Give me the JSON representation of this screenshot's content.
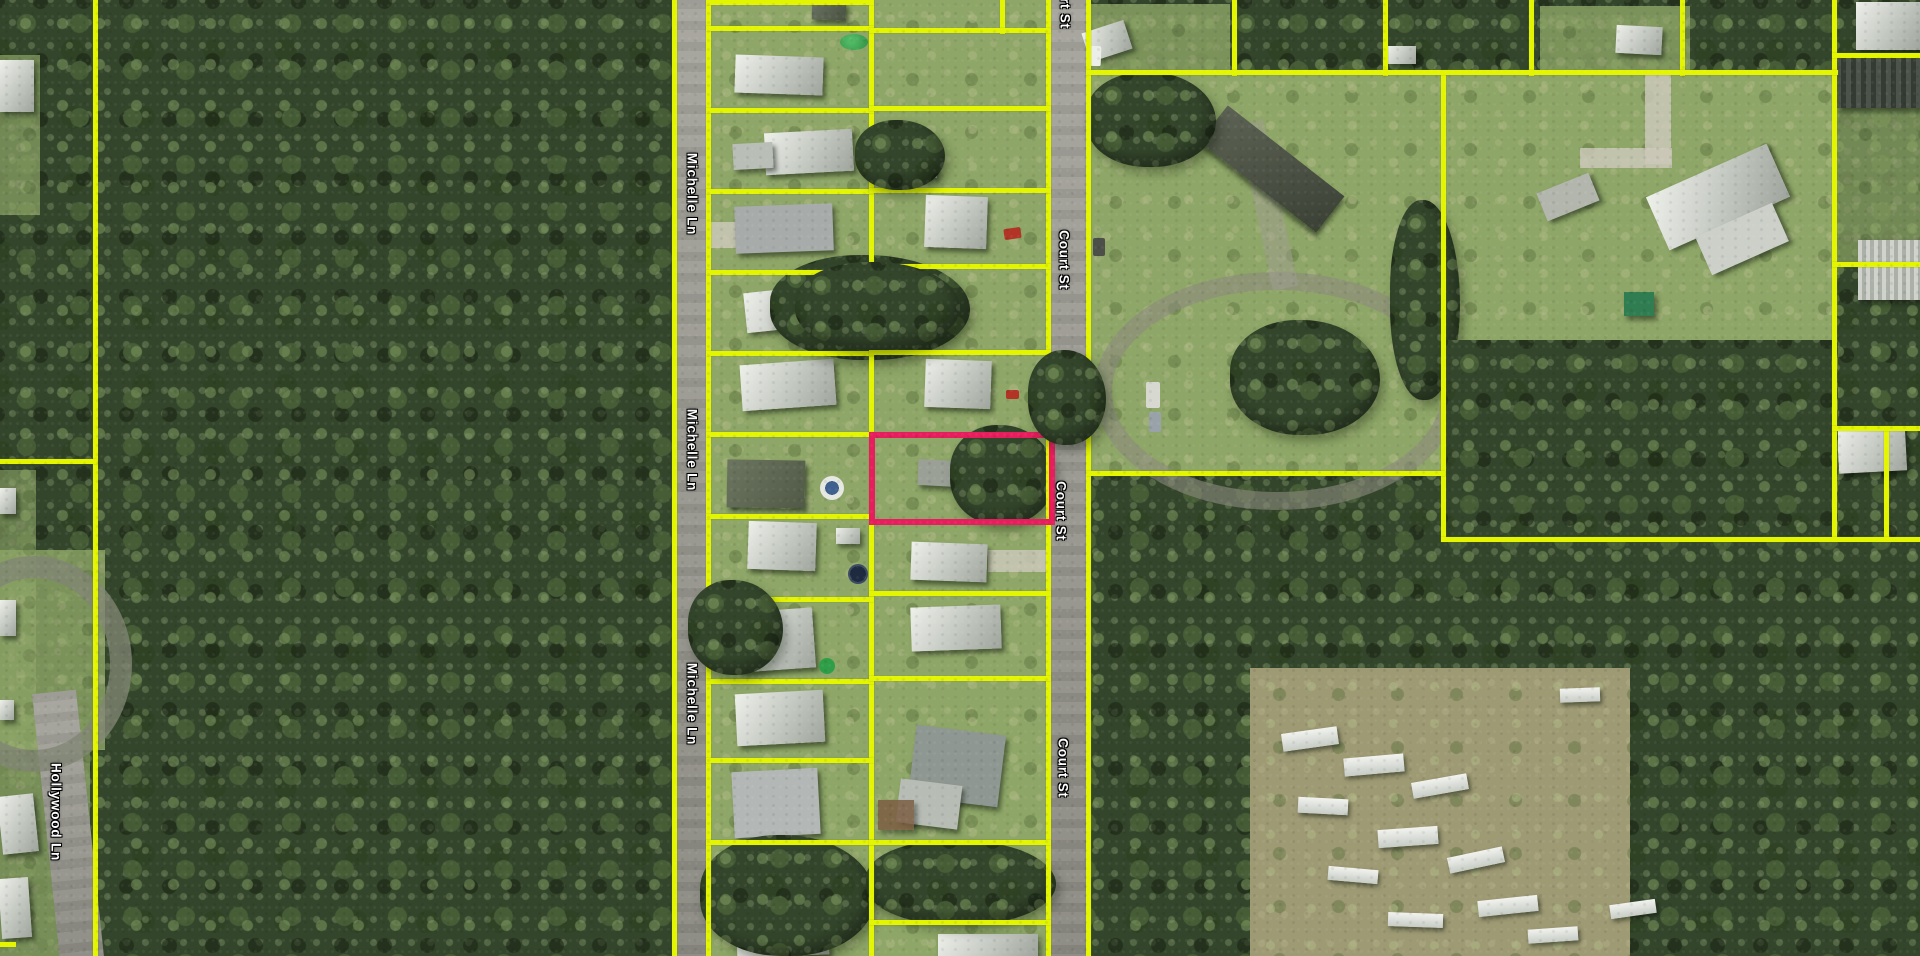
{
  "map": {
    "kind": "aerial-parcel-map",
    "colors": {
      "parcel_line": "#e4f501",
      "highlight_outline": "#e61e5e",
      "road": "#9d9c94"
    },
    "streets": [
      "Michelle Ln",
      "Court St",
      "Hollywood Ln"
    ],
    "labels": [
      {
        "id": "michelle-1",
        "text": "Michelle Ln"
      },
      {
        "id": "michelle-2",
        "text": "Michelle Ln"
      },
      {
        "id": "michelle-3",
        "text": "Michelle Ln"
      },
      {
        "id": "court-top-partial",
        "text": "Court St"
      },
      {
        "id": "court-1",
        "text": "Court St"
      },
      {
        "id": "court-2",
        "text": "Court St"
      },
      {
        "id": "court-3",
        "text": "Court St"
      },
      {
        "id": "hollywood-1",
        "text": "Hollywood Ln"
      }
    ],
    "highlighted_parcel": {
      "description": "Parcel outlined in pink, east side of Michelle Ln block fronting Court St"
    }
  }
}
